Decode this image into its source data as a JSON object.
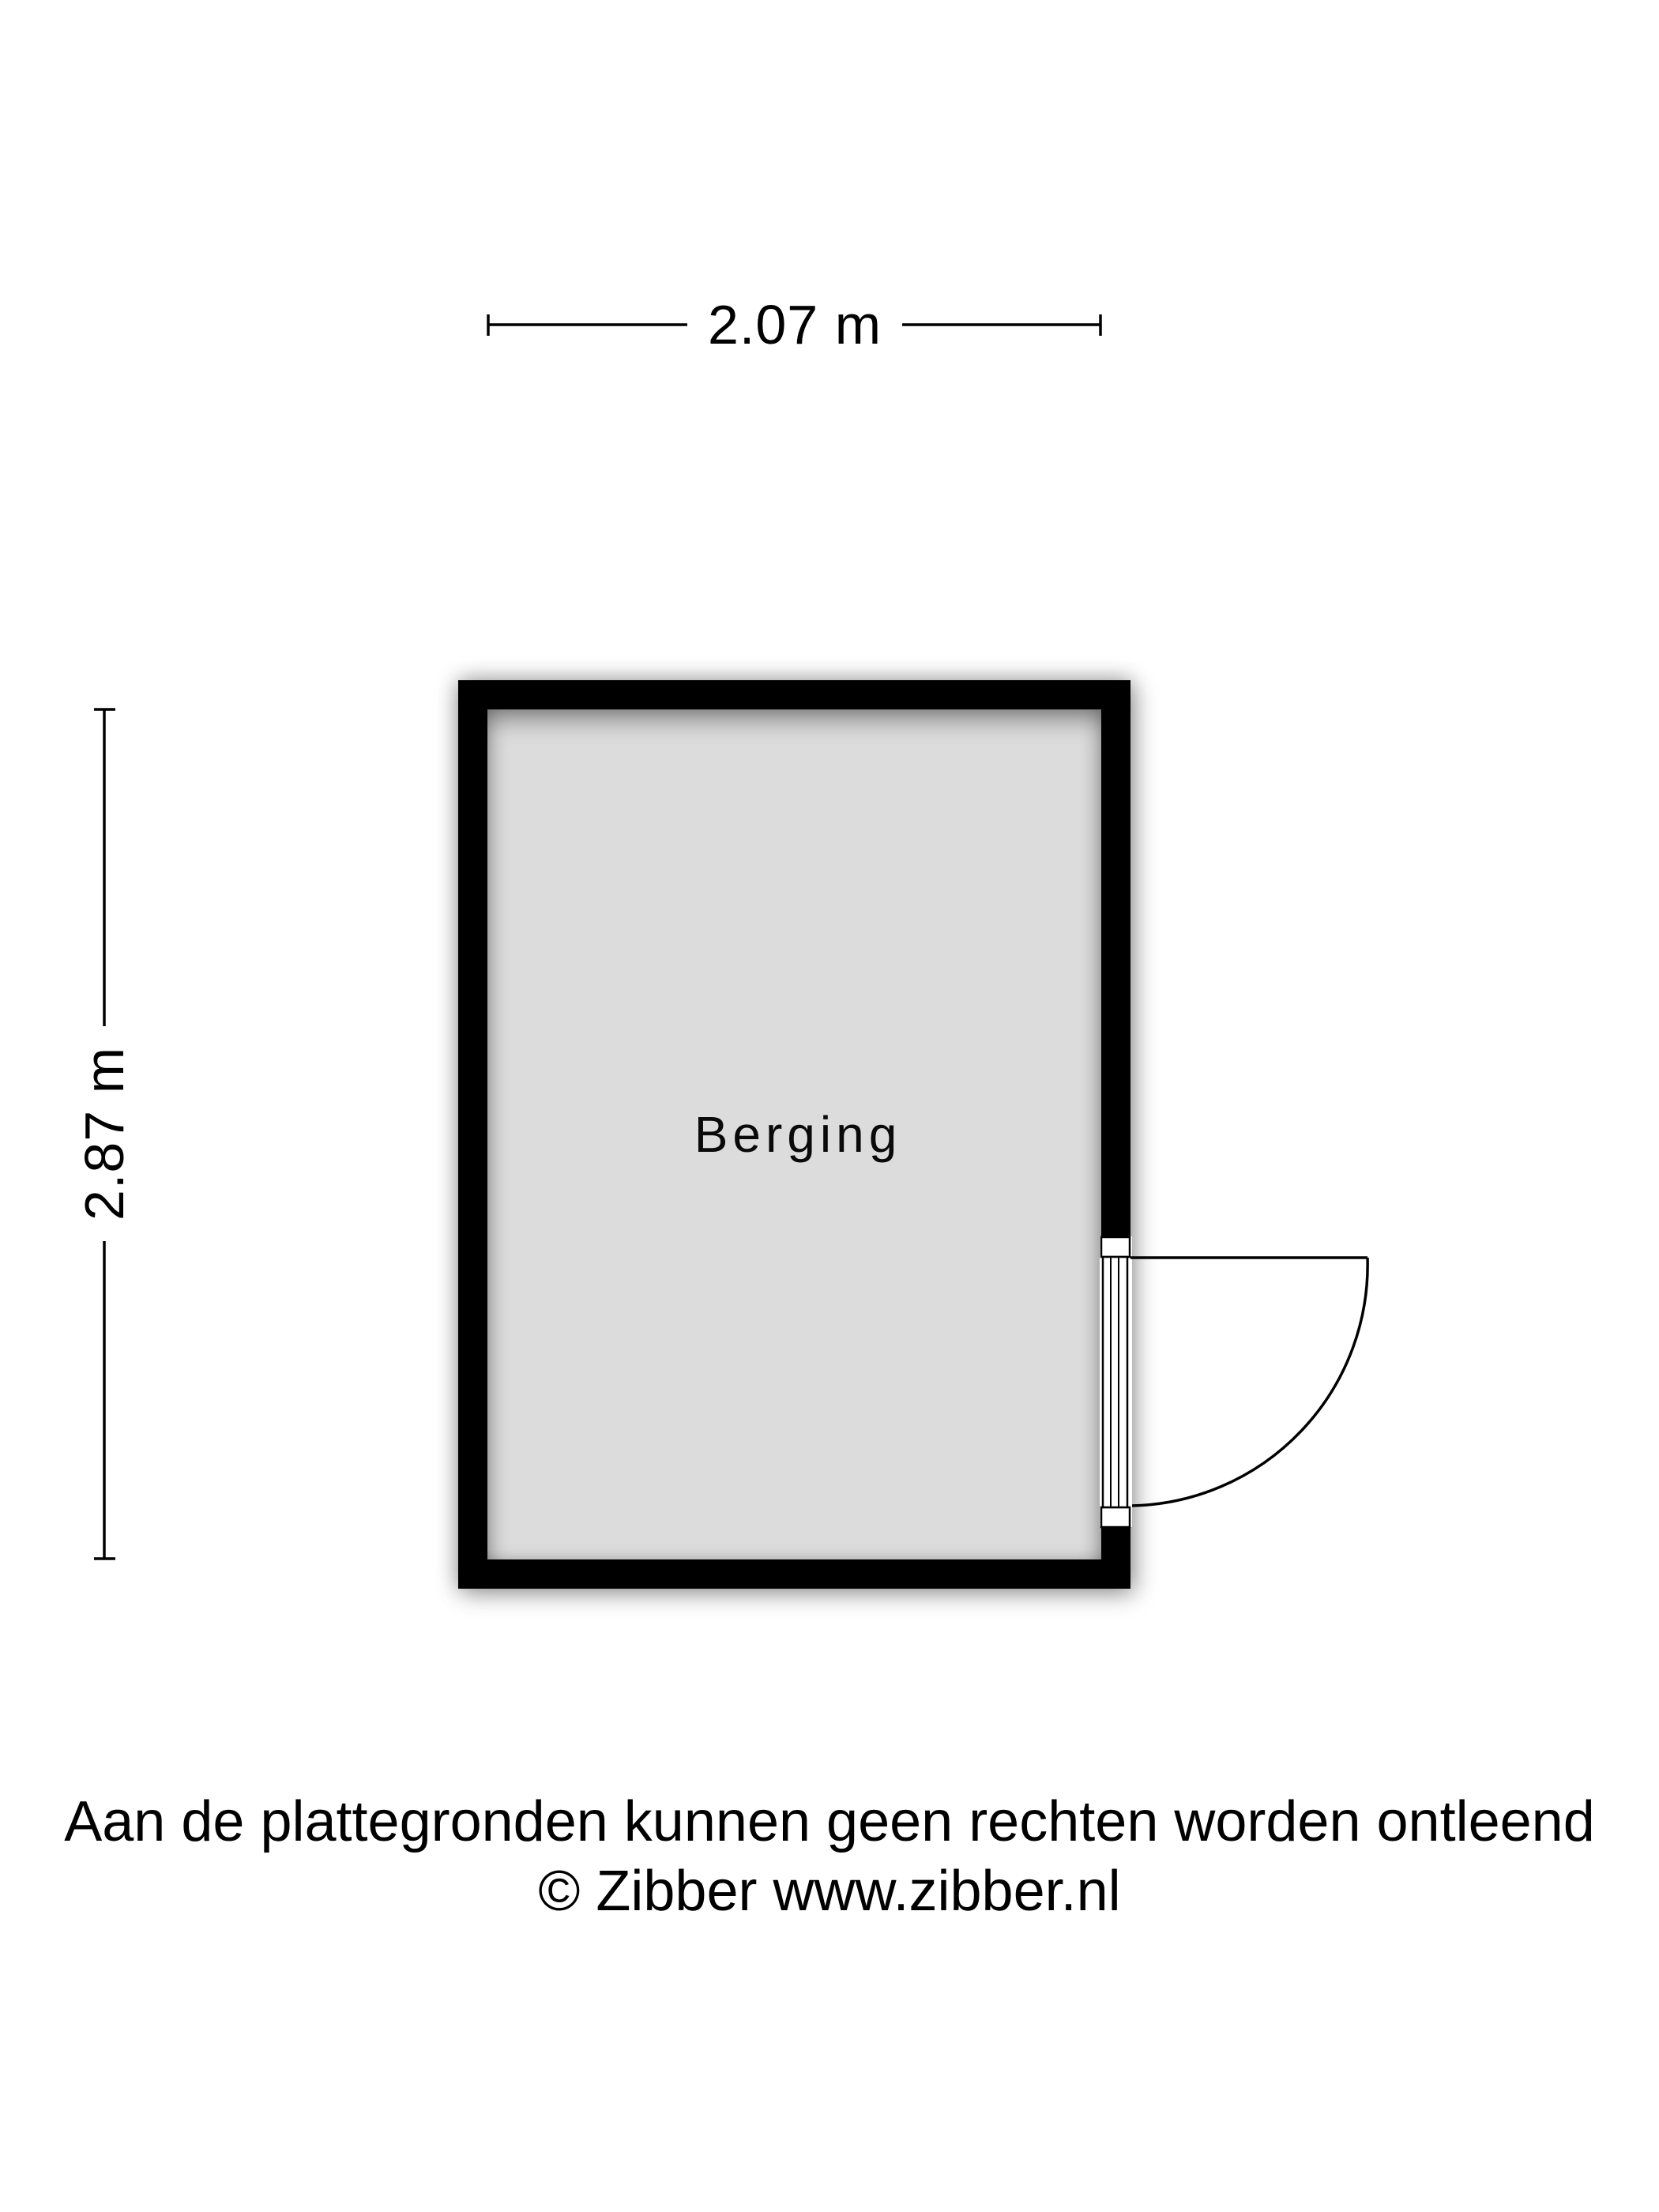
{
  "floorplan": {
    "room": {
      "name": "Berging",
      "width_label": "2.07 m",
      "height_label": "2.87 m"
    },
    "colors": {
      "background": "#ffffff",
      "wall": "#000000",
      "floor": "#dcdcdc",
      "dimension_lines": "#000000",
      "door_fill": "#ffffff",
      "door_stroke": "#000000"
    }
  },
  "footer": {
    "disclaimer": "Aan de plattegronden kunnen geen rechten worden ontleend",
    "copyright": "© Zibber www.zibber.nl"
  }
}
